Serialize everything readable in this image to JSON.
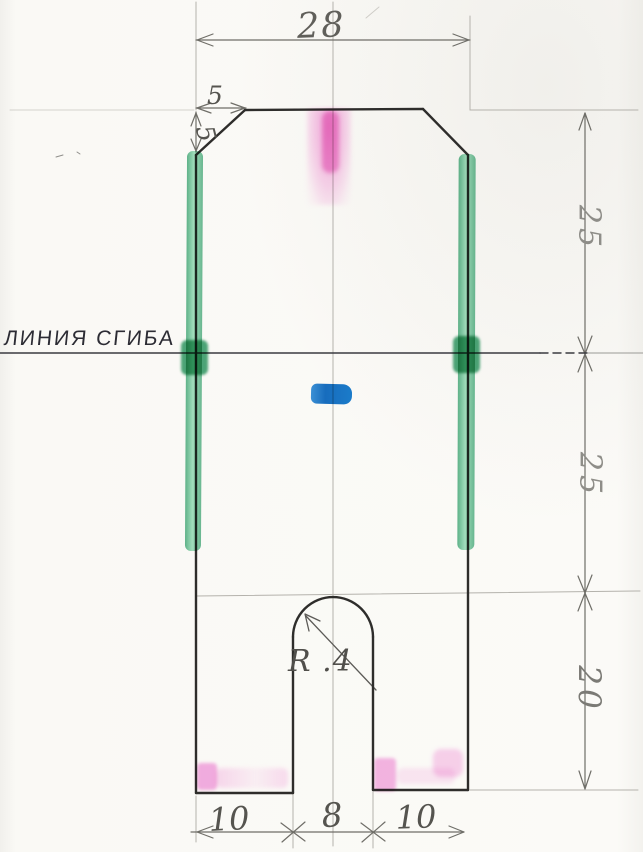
{
  "drawing": {
    "fold_line_label": "ЛИНИЯ СГИБА",
    "dimensions": {
      "top_width": "28",
      "chamfer_width": "5",
      "chamfer_height": "5",
      "upper_height": "25",
      "middle_height": "25",
      "lower_height": "20",
      "notch_radius": "R .4",
      "bottom_left_width": "10",
      "notch_width": "8",
      "bottom_right_width": "10"
    },
    "highlight_colors": {
      "green": "#2fae6f",
      "green_dark": "#1f9158",
      "pink": "#ee64c4",
      "blue": "#1b7ed2"
    },
    "ink_colors": {
      "outline": "#2e2d2b",
      "pencil_dim": "#6f6e68",
      "construction": "#b4b2ac",
      "fold_line": "#3a3a40"
    }
  }
}
